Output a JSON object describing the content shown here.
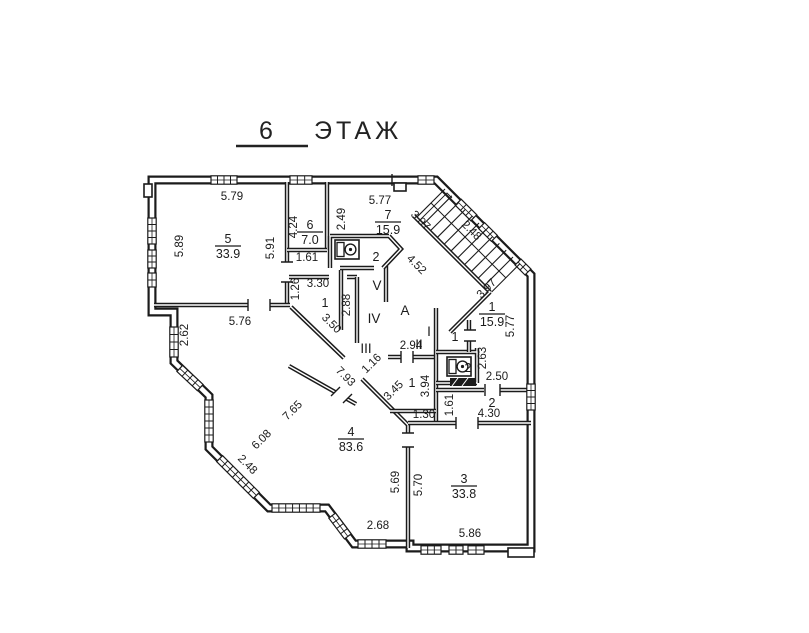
{
  "title": {
    "floor_number": "6",
    "floor_word": "ЭТАЖ"
  },
  "colors": {
    "ink": "#1b1b1b",
    "paper": "#ffffff"
  },
  "plan": {
    "dims": [
      {
        "t": "5.79",
        "x": 232,
        "y": 200,
        "r": 0
      },
      {
        "t": "5.77",
        "x": 380,
        "y": 204,
        "r": 0
      },
      {
        "t": "1.61",
        "x": 307,
        "y": 261,
        "r": 0
      },
      {
        "t": "3.30",
        "x": 318,
        "y": 287,
        "r": 0
      },
      {
        "t": "5.76",
        "x": 240,
        "y": 325,
        "r": 0
      },
      {
        "t": "2.94",
        "x": 411,
        "y": 349,
        "r": 0
      },
      {
        "t": "1.30",
        "x": 424,
        "y": 418,
        "r": 0
      },
      {
        "t": "2.50",
        "x": 497,
        "y": 380,
        "r": 0
      },
      {
        "t": "4.30",
        "x": 489,
        "y": 417,
        "r": 0
      },
      {
        "t": "2.68",
        "x": 378,
        "y": 529,
        "r": 0
      },
      {
        "t": "5.86",
        "x": 470,
        "y": 537,
        "r": 0
      },
      {
        "t": "5.89",
        "x": 183,
        "y": 246,
        "r": -90
      },
      {
        "t": "5.91",
        "x": 274,
        "y": 248,
        "r": -90
      },
      {
        "t": "4.24",
        "x": 297,
        "y": 227,
        "r": -90
      },
      {
        "t": "2.49",
        "x": 345,
        "y": 219,
        "r": -90
      },
      {
        "t": "1.26",
        "x": 299,
        "y": 289,
        "r": -90
      },
      {
        "t": "2.88",
        "x": 350,
        "y": 305,
        "r": -90
      },
      {
        "t": "2.62",
        "x": 188,
        "y": 335,
        "r": -90
      },
      {
        "t": "2.63",
        "x": 486,
        "y": 358,
        "r": -90
      },
      {
        "t": "3.94",
        "x": 429,
        "y": 386,
        "r": -90
      },
      {
        "t": "1.61",
        "x": 453,
        "y": 405,
        "r": -90
      },
      {
        "t": "5.77",
        "x": 514,
        "y": 326,
        "r": -90
      },
      {
        "t": "5.69",
        "x": 399,
        "y": 482,
        "r": -90
      },
      {
        "t": "5.70",
        "x": 422,
        "y": 485,
        "r": -90
      },
      {
        "t": "3.97",
        "x": 418,
        "y": 223,
        "r": 45
      },
      {
        "t": "2.48",
        "x": 469,
        "y": 233,
        "r": 45
      },
      {
        "t": "4.52",
        "x": 414,
        "y": 267,
        "r": 45
      },
      {
        "t": "3.50",
        "x": 329,
        "y": 326,
        "r": 45
      },
      {
        "t": "7.93",
        "x": 343,
        "y": 379,
        "r": 45
      },
      {
        "t": "2.48",
        "x": 245,
        "y": 467,
        "r": 45
      },
      {
        "t": "3.97",
        "x": 489,
        "y": 291,
        "r": -45
      },
      {
        "t": "1.16",
        "x": 374,
        "y": 366,
        "r": -45
      },
      {
        "t": "3.45",
        "x": 396,
        "y": 393,
        "r": -45
      },
      {
        "t": "6.08",
        "x": 264,
        "y": 442,
        "r": -45
      },
      {
        "t": "7.65",
        "x": 295,
        "y": 413,
        "r": -45
      }
    ],
    "rooms": [
      {
        "n": "5",
        "a": "33.9",
        "x": 228,
        "y": 246
      },
      {
        "n": "6",
        "a": "7.0",
        "x": 310,
        "y": 232
      },
      {
        "n": "7",
        "a": "15.9",
        "x": 388,
        "y": 222
      },
      {
        "n": "1",
        "a": "15.9",
        "x": 492,
        "y": 314
      },
      {
        "n": "4",
        "a": "83.6",
        "x": 351,
        "y": 439
      },
      {
        "n": "3",
        "a": "33.8",
        "x": 464,
        "y": 486
      }
    ],
    "small_rooms": [
      {
        "t": "1",
        "x": 325,
        "y": 307
      },
      {
        "t": "2",
        "x": 376,
        "y": 261
      },
      {
        "t": "1",
        "x": 455,
        "y": 341
      },
      {
        "t": "2",
        "x": 468,
        "y": 372
      },
      {
        "t": "1",
        "x": 412,
        "y": 387
      },
      {
        "t": "2",
        "x": 492,
        "y": 407
      }
    ],
    "zones": [
      {
        "t": "А",
        "x": 405,
        "y": 315
      },
      {
        "t": "V",
        "x": 377,
        "y": 290
      },
      {
        "t": "IV",
        "x": 374,
        "y": 323
      },
      {
        "t": "III",
        "x": 366,
        "y": 353
      },
      {
        "t": "II",
        "x": 419,
        "y": 349
      },
      {
        "t": "I",
        "x": 429,
        "y": 336
      }
    ]
  }
}
